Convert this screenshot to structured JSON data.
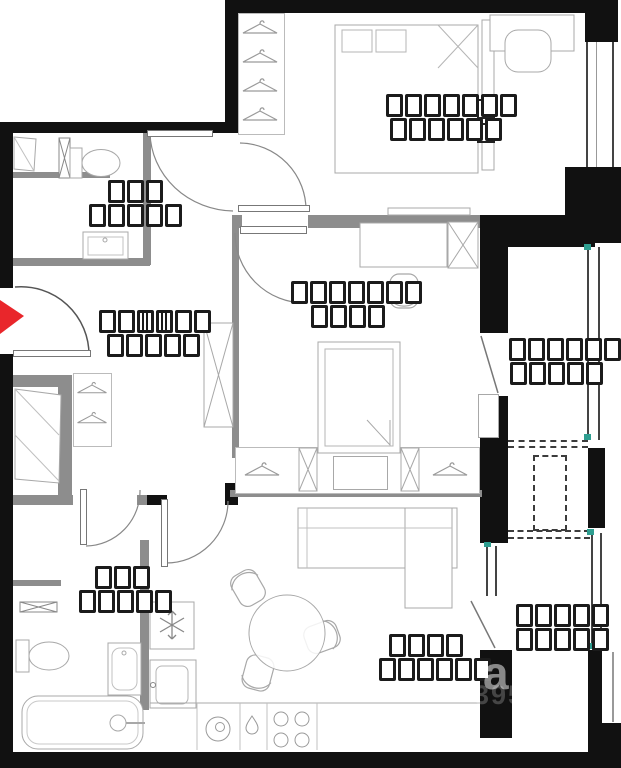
{
  "meta": {
    "type": "apartment-floor-plan",
    "description": "2D black-and-white apartment floor plan with red entrance arrow and box-glyph (unrendered font) room labels"
  },
  "colors": {
    "wall": "#111111",
    "partition": "#8d8d8d",
    "furniture_stroke": "#a8a8a8",
    "entry_arrow": "#e9262b",
    "window_tick": "#2e9e90",
    "label_box": "#1b1b1b"
  },
  "labels": {
    "wc_top": {
      "rows": [
        "bbb",
        "bbbbb"
      ]
    },
    "bedroom_top": {
      "rows": [
        "bbbbbbb",
        "bbbbbb"
      ]
    },
    "bedroom_mid": {
      "rows": [
        "bbbbbbb",
        "bbbb"
      ]
    },
    "hallway": {
      "rows": [
        "bbmmbb",
        "bbbbb"
      ]
    },
    "loggia_top": {
      "rows": [
        "bbbbbb",
        "bbbbb"
      ]
    },
    "bathroom_bottom": {
      "rows": [
        "bbb",
        "bbbbb"
      ]
    },
    "kitchen_living": {
      "rows": [
        "bbbb",
        "bbbbbb"
      ]
    },
    "loggia_bottom": {
      "rows": [
        "bbbbb",
        "bbbbb"
      ]
    }
  },
  "watermark": {
    "letter": "а",
    "digits": "395"
  },
  "entry": {
    "direction": "right"
  }
}
